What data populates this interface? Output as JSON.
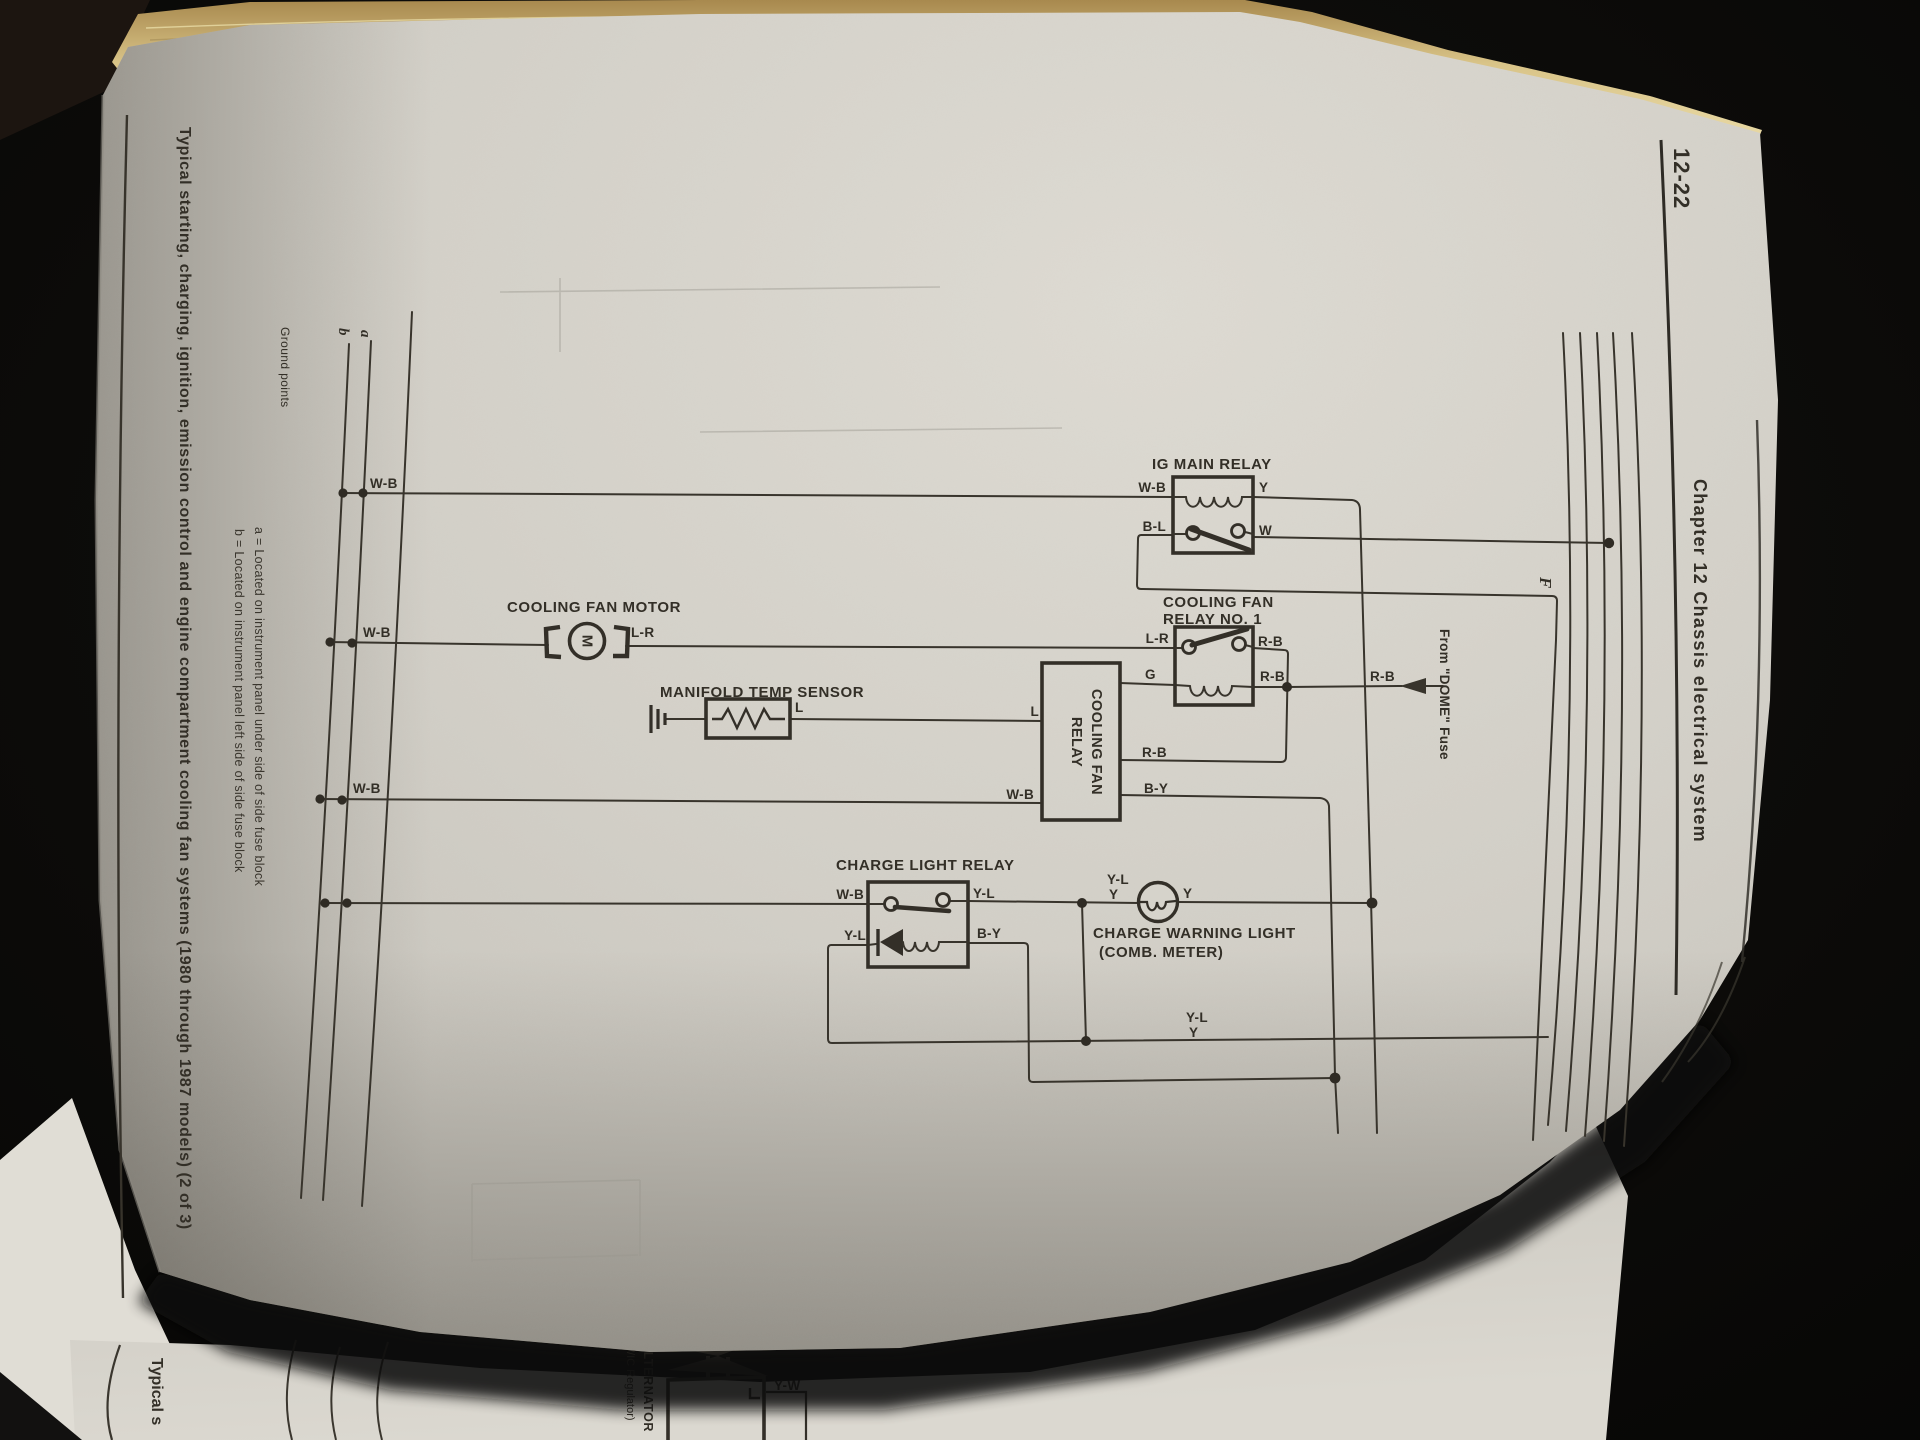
{
  "header": {
    "page_number": "12-22",
    "chapter_title": "Chapter 12  Chassis electrical system"
  },
  "caption": {
    "text": "Typical starting, charging, ignition, emission control and engine compartment cooling fan systems (1980 through 1987 models) (2 of 3)"
  },
  "ground": {
    "label": "Ground points",
    "note_a": "a = Located on instrument panel under side of side fuse block",
    "note_b": "b = Located on instrument panel left side of side fuse block",
    "bus_a": "a",
    "bus_b": "b"
  },
  "diagram": {
    "bus_wb_1": "W-B",
    "bus_wb_2": "W-B",
    "bus_wb_3": "W-B",
    "ig_relay": {
      "title": "IG MAIN RELAY",
      "wb": "W-B",
      "y": "Y",
      "bl": "B-L",
      "w": "W"
    },
    "connector_f": "F",
    "fan_motor": {
      "title": "COOLING FAN MOTOR",
      "m": "M",
      "lr": "L-R"
    },
    "temp_sensor": {
      "title": "MANIFOLD TEMP SENSOR",
      "l": "L"
    },
    "fan_relay_module": {
      "line1": "COOLING FAN",
      "line2": "RELAY",
      "l": "L",
      "wb": "W-B",
      "g": "G",
      "rb": "R-B",
      "by": "B-Y"
    },
    "fan_relay_1": {
      "line1": "COOLING FAN",
      "line2": "RELAY NO. 1",
      "lr": "L-R",
      "rb_top": "R-B",
      "rb_mid": "R-B"
    },
    "dome": {
      "rb": "R-B",
      "source": "From \"DOME\" Fuse"
    },
    "charge_relay": {
      "title": "CHARGE LIGHT RELAY",
      "wb": "W-B",
      "yl_top": "Y-L",
      "yl_low": "Y-L",
      "by": "B-Y"
    },
    "warning_light": {
      "yl": "Y-L",
      "y_left": "Y",
      "y_right": "Y",
      "line1": "CHARGE WARNING LIGHT",
      "line2": "(COMB. METER)"
    },
    "bottom_wire": {
      "yl": "Y-L",
      "y": "Y"
    }
  },
  "next_page": {
    "caption_start": "Typical s",
    "alternator_line1": "ALTERNATOR",
    "alternator_line2": "(W/IC Regulator)",
    "yw": "Y-W"
  }
}
